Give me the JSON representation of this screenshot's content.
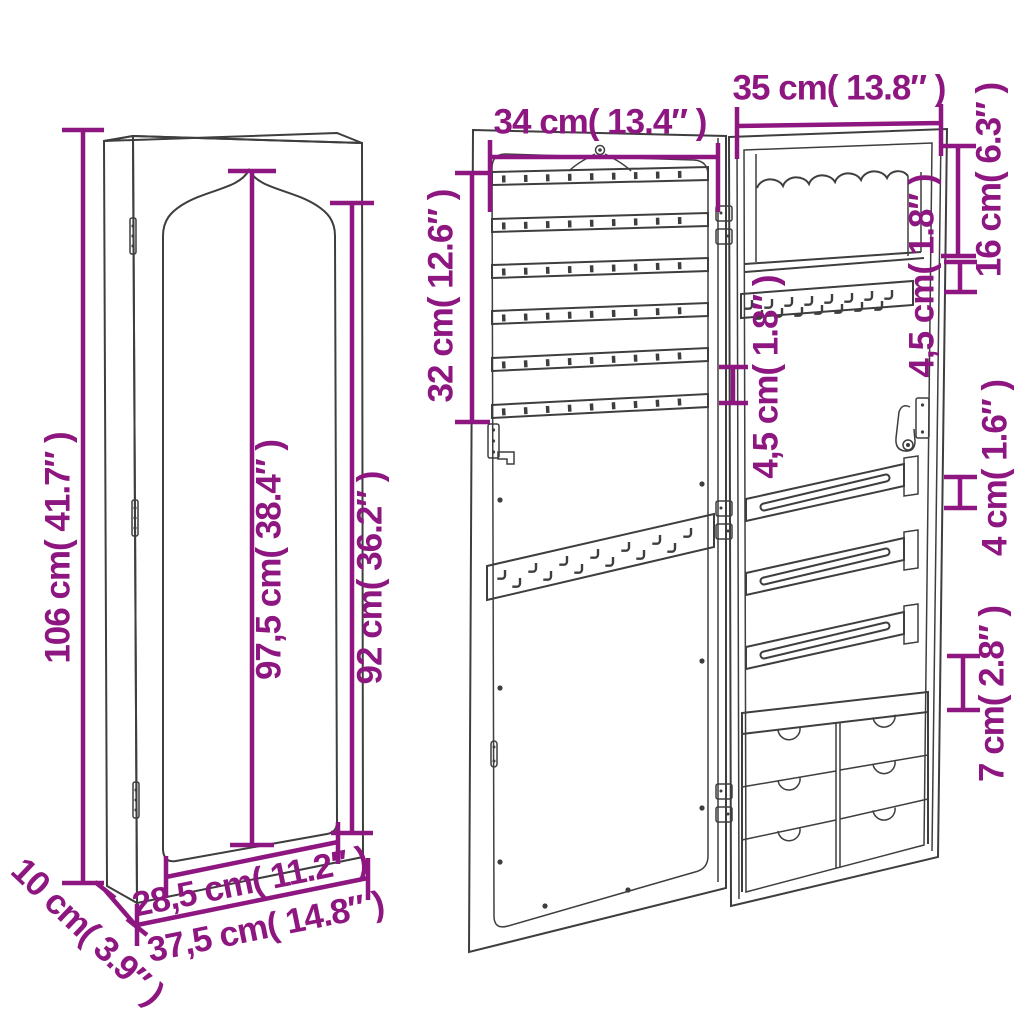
{
  "colors": {
    "dimension_text": "#8e1680",
    "drawing_line": "#3e3e3e",
    "background": "#ffffff"
  },
  "views": {
    "closed": {
      "dims": {
        "total_height": "106 cm( 41.7″ )",
        "mirror_peak_height": "97,5 cm( 38.4″ )",
        "mirror_side_height": "92 cm( 36.2″ )",
        "mirror_width": "28,5 cm( 11.2″ )",
        "total_width": "37,5 cm( 14.8″ )",
        "depth": "10 cm( 3.9″ )"
      }
    },
    "open": {
      "dims": {
        "door_width": "34 cm( 13.4″ )",
        "cabinet_width": "35 cm( 13.8″ )",
        "rack_height": "32 cm( 12.6″ )",
        "top_section_height": "16 cm( 6.3″ )",
        "top_shelf_gap": "4,5 cm( 1.8″ )",
        "inner_hook_gap": "4,5 cm( 1.8″ )",
        "rod_height": "4 cm( 1.6″ )",
        "drawer_gap": "7 cm( 2.8″ )"
      }
    }
  }
}
